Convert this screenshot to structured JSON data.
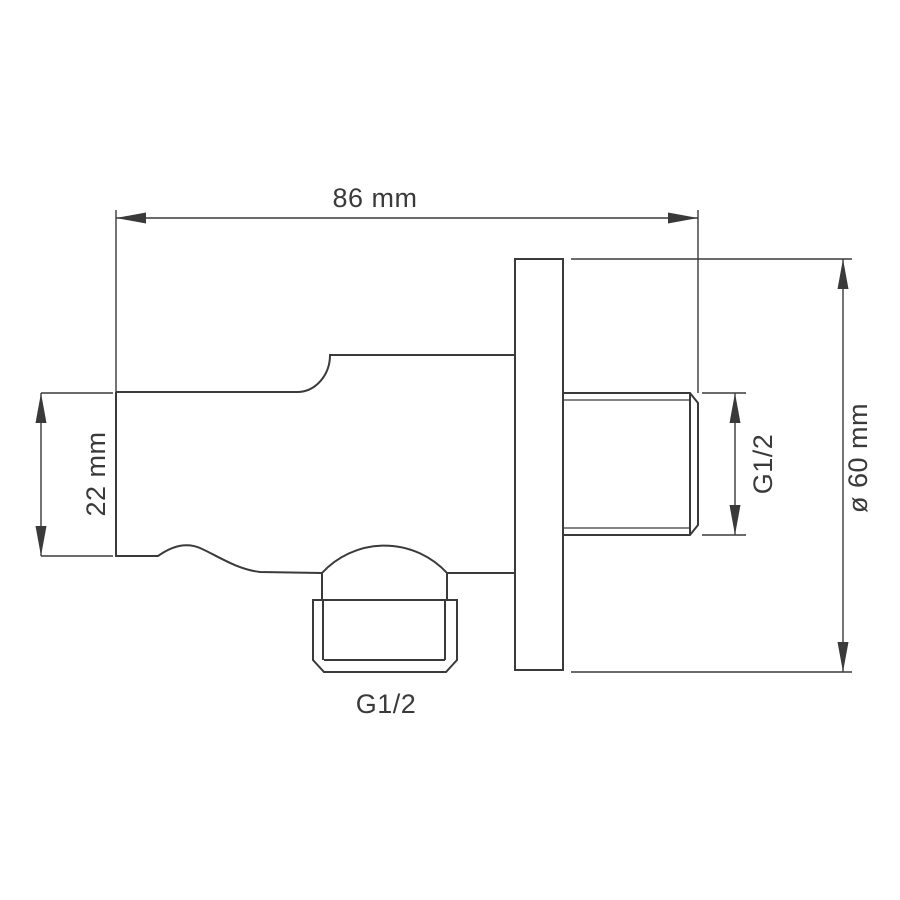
{
  "drawing": {
    "background_color": "#ffffff",
    "line_color": "#3a3a3a",
    "dimensions": [
      {
        "id": "overall-depth",
        "label": "86 mm",
        "orientation": "horizontal",
        "position": "top"
      },
      {
        "id": "bracket-height",
        "label": "22 mm",
        "orientation": "vertical",
        "position": "left"
      },
      {
        "id": "wall-thread-size",
        "label": "G1/2",
        "orientation": "vertical",
        "position": "right-of-thread"
      },
      {
        "id": "flange-diameter",
        "label": "ø 60 mm",
        "orientation": "vertical",
        "position": "far-right"
      },
      {
        "id": "hose-thread-size",
        "label": "G1/2",
        "orientation": "horizontal",
        "position": "bottom"
      }
    ]
  }
}
